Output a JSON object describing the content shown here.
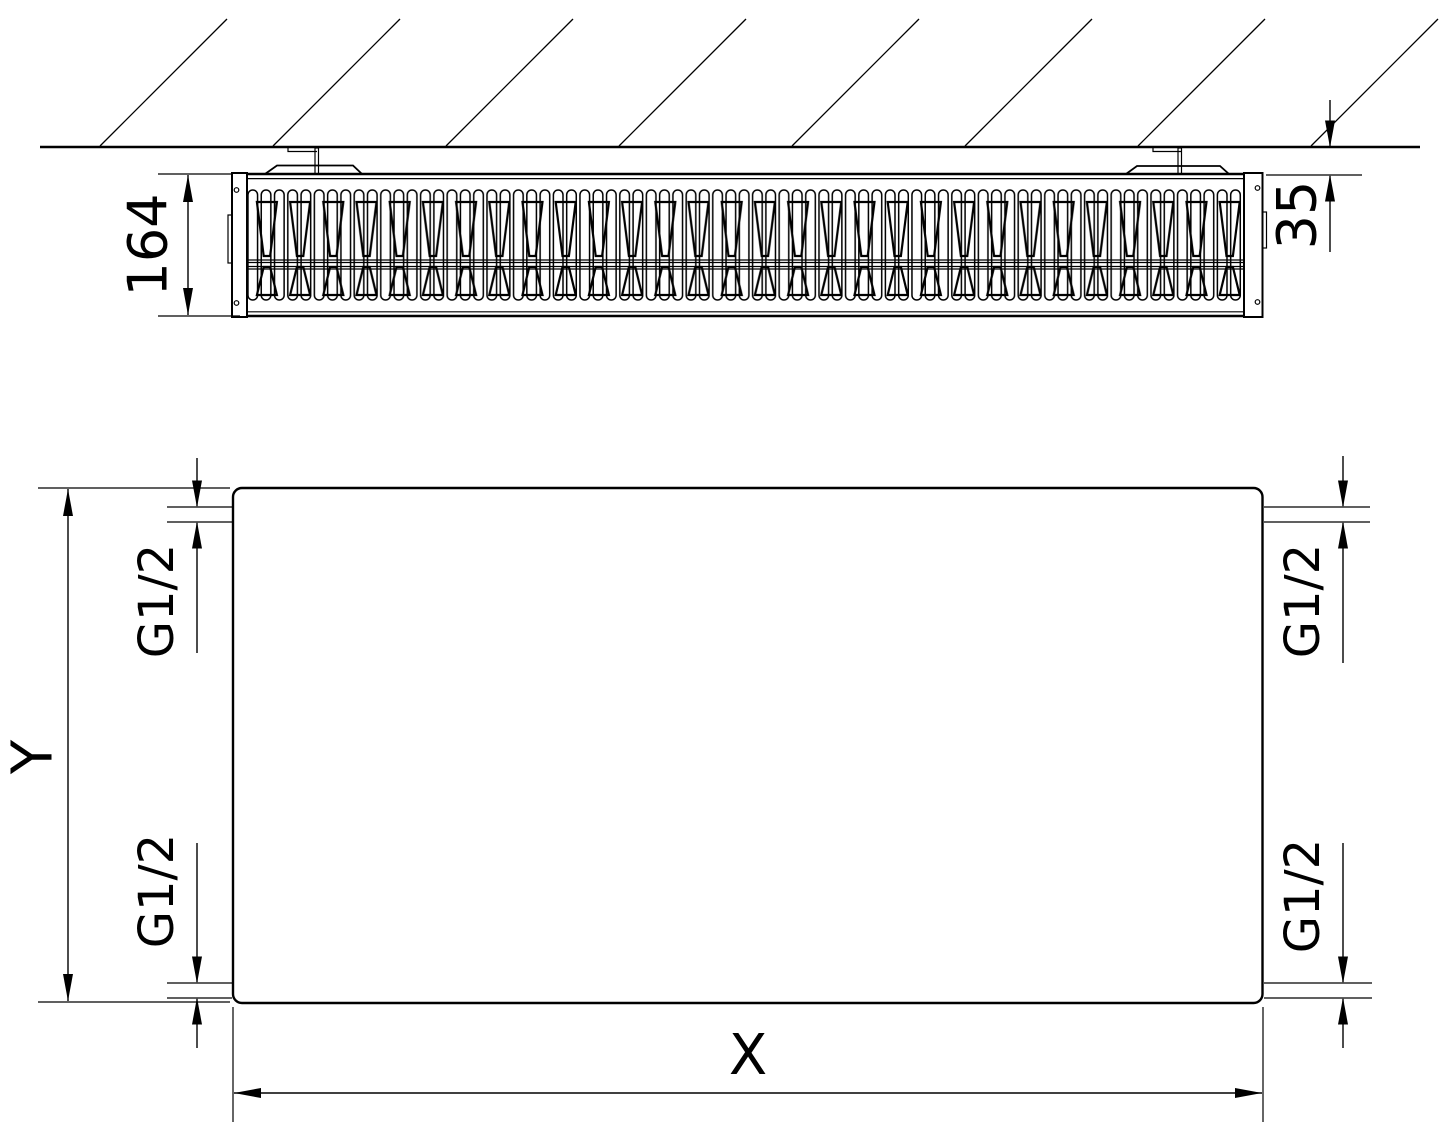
{
  "labels": {
    "depth": "164",
    "wall_distance": "35",
    "height": "Y",
    "width": "X",
    "conn_top_left": "G1/2",
    "conn_bottom_left": "G1/2",
    "conn_top_right": "G1/2",
    "conn_bottom_right": "G1/2"
  },
  "colors": {
    "line": "#000000",
    "background": "#ffffff",
    "text": "#000000"
  }
}
